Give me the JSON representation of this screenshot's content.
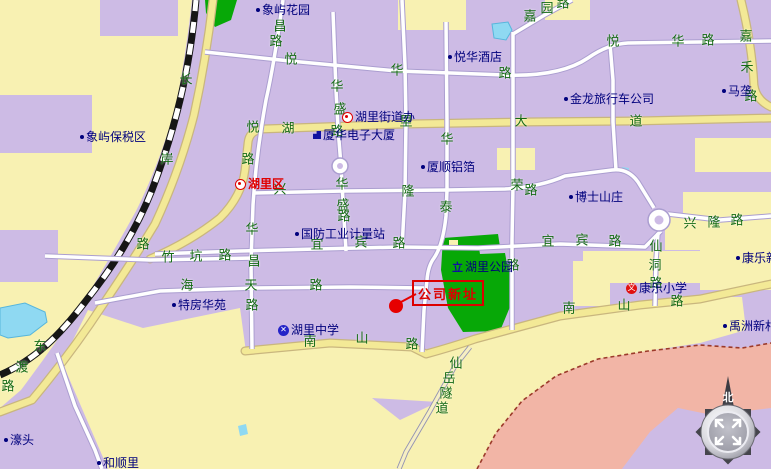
{
  "map": {
    "title": "湖里区地图",
    "colors": {
      "land_lavender": "#cdbbe5",
      "district_yellow": "#f8f1b2",
      "major_road_fill": "#f3e996",
      "minor_road_fill": "#ffffff",
      "park_green": "#07a807",
      "water_cyan": "#8fd9f2",
      "mountain_salmon": "#f2b5a6",
      "boundary_red": "#9c3a2a",
      "road_label_green": "#156b15",
      "poi_label_blue": "#00007d",
      "admin_label_red": "#e00000",
      "target_red": "#dd0000"
    },
    "road_chars": [
      [
        "长",
        186,
        80
      ],
      [
        "岸",
        167,
        160
      ],
      [
        "路",
        143,
        245
      ],
      [
        "东",
        40,
        347
      ],
      [
        "渡",
        22,
        368
      ],
      [
        "路",
        8,
        387
      ],
      [
        "昌",
        280,
        27
      ],
      [
        "路",
        276,
        42
      ],
      [
        "悦",
        291,
        60
      ],
      [
        "华",
        397,
        71
      ],
      [
        "路",
        505,
        74
      ],
      [
        "悦",
        613,
        42
      ],
      [
        "华",
        678,
        42
      ],
      [
        "路",
        708,
        41
      ],
      [
        "嘉",
        530,
        17
      ],
      [
        "园",
        547,
        9
      ],
      [
        "路",
        563,
        4
      ],
      [
        "嘉",
        746,
        37
      ],
      [
        "禾",
        747,
        68
      ],
      [
        "路",
        751,
        97
      ],
      [
        "华",
        337,
        87
      ],
      [
        "盛",
        340,
        110
      ],
      [
        "路",
        337,
        132
      ],
      [
        "华",
        342,
        185
      ],
      [
        "盛",
        343,
        206
      ],
      [
        "路",
        344,
        217
      ],
      [
        "悦",
        253,
        128
      ],
      [
        "湖",
        288,
        129
      ],
      [
        "路",
        248,
        160
      ],
      [
        "里",
        406,
        122
      ],
      [
        "大",
        521,
        122
      ],
      [
        "道",
        636,
        122
      ],
      [
        "华",
        447,
        140
      ],
      [
        "荣",
        517,
        186
      ],
      [
        "路",
        531,
        191
      ],
      [
        "兴",
        280,
        190
      ],
      [
        "隆",
        408,
        192
      ],
      [
        "泰",
        446,
        208
      ],
      [
        "兴",
        690,
        224
      ],
      [
        "隆",
        714,
        223
      ],
      [
        "路",
        737,
        221
      ],
      [
        "宜",
        317,
        245
      ],
      [
        "宾",
        361,
        243
      ],
      [
        "路",
        399,
        244
      ],
      [
        "宜",
        548,
        242
      ],
      [
        "宾",
        582,
        241
      ],
      [
        "路",
        615,
        242
      ],
      [
        "仙",
        656,
        247
      ],
      [
        "洞",
        655,
        266
      ],
      [
        "路",
        656,
        284
      ],
      [
        "竹",
        168,
        258
      ],
      [
        "坑",
        196,
        257
      ],
      [
        "路",
        225,
        256
      ],
      [
        "海",
        187,
        286
      ],
      [
        "天",
        251,
        286
      ],
      [
        "路",
        316,
        286
      ],
      [
        "华",
        252,
        230
      ],
      [
        "昌",
        254,
        262
      ],
      [
        "路",
        252,
        306
      ],
      [
        "南",
        310,
        342
      ],
      [
        "山",
        362,
        339
      ],
      [
        "路",
        412,
        345
      ],
      [
        "南",
        569,
        309
      ],
      [
        "山",
        624,
        306
      ],
      [
        "路",
        677,
        302
      ],
      [
        "路",
        513,
        266
      ],
      [
        "仙",
        456,
        364
      ],
      [
        "岳",
        449,
        379
      ],
      [
        "隧",
        446,
        394
      ],
      [
        "道",
        442,
        409
      ]
    ],
    "pois": [
      {
        "name": "象屿花园",
        "marker": "dot",
        "x": 256,
        "y": 10
      },
      {
        "name": "悦华酒店",
        "marker": "dot",
        "x": 448,
        "y": 57
      },
      {
        "name": "金龙旅行车公司",
        "marker": "dot",
        "x": 564,
        "y": 99
      },
      {
        "name": "马垄",
        "marker": "dot",
        "x": 722,
        "y": 91
      },
      {
        "name": "湖里街道办",
        "marker": "circle-red",
        "x": 342,
        "y": 117
      },
      {
        "name": "厦华电子大厦",
        "marker": "building",
        "x": 313,
        "y": 135
      },
      {
        "name": "厦顺铝箔",
        "marker": "dot",
        "x": 421,
        "y": 167
      },
      {
        "name": "博士山庄",
        "marker": "dot",
        "x": 569,
        "y": 197
      },
      {
        "name": "象屿保税区",
        "marker": "dot",
        "x": 80,
        "y": 137
      },
      {
        "name": "特房华苑",
        "marker": "dot",
        "x": 172,
        "y": 305
      },
      {
        "name": "湖里中学",
        "marker": "school-blue",
        "x": 278,
        "y": 330
      },
      {
        "name": "康乐小学",
        "marker": "school-red",
        "x": 626,
        "y": 288
      },
      {
        "name": "康乐新村",
        "marker": "dot",
        "x": 736,
        "y": 258
      },
      {
        "name": "禹洲新村",
        "marker": "dot",
        "x": 723,
        "y": 326
      },
      {
        "name": "濠头",
        "marker": "dot",
        "x": 4,
        "y": 440
      },
      {
        "name": "和顺里",
        "marker": "dot",
        "x": 97,
        "y": 463
      },
      {
        "name": "国防工业计量站",
        "marker": "dot",
        "x": 295,
        "y": 234
      },
      {
        "name": "湖里公园",
        "marker": "monument",
        "x": 452,
        "y": 267
      }
    ],
    "marker_glyphs": {
      "school_blue": "✕",
      "school_red": "文",
      "monument": "立"
    },
    "admin_label": {
      "name": "湖里区",
      "marker": "circle-red",
      "x": 235,
      "y": 184
    },
    "target": {
      "label": "公司新址",
      "box": {
        "x": 412,
        "y": 280,
        "w": 68,
        "h": 22
      },
      "dot": {
        "x": 396,
        "y": 306
      }
    },
    "compass": {
      "north_label": "北",
      "pan_icon": "diagonal-arrows"
    }
  }
}
